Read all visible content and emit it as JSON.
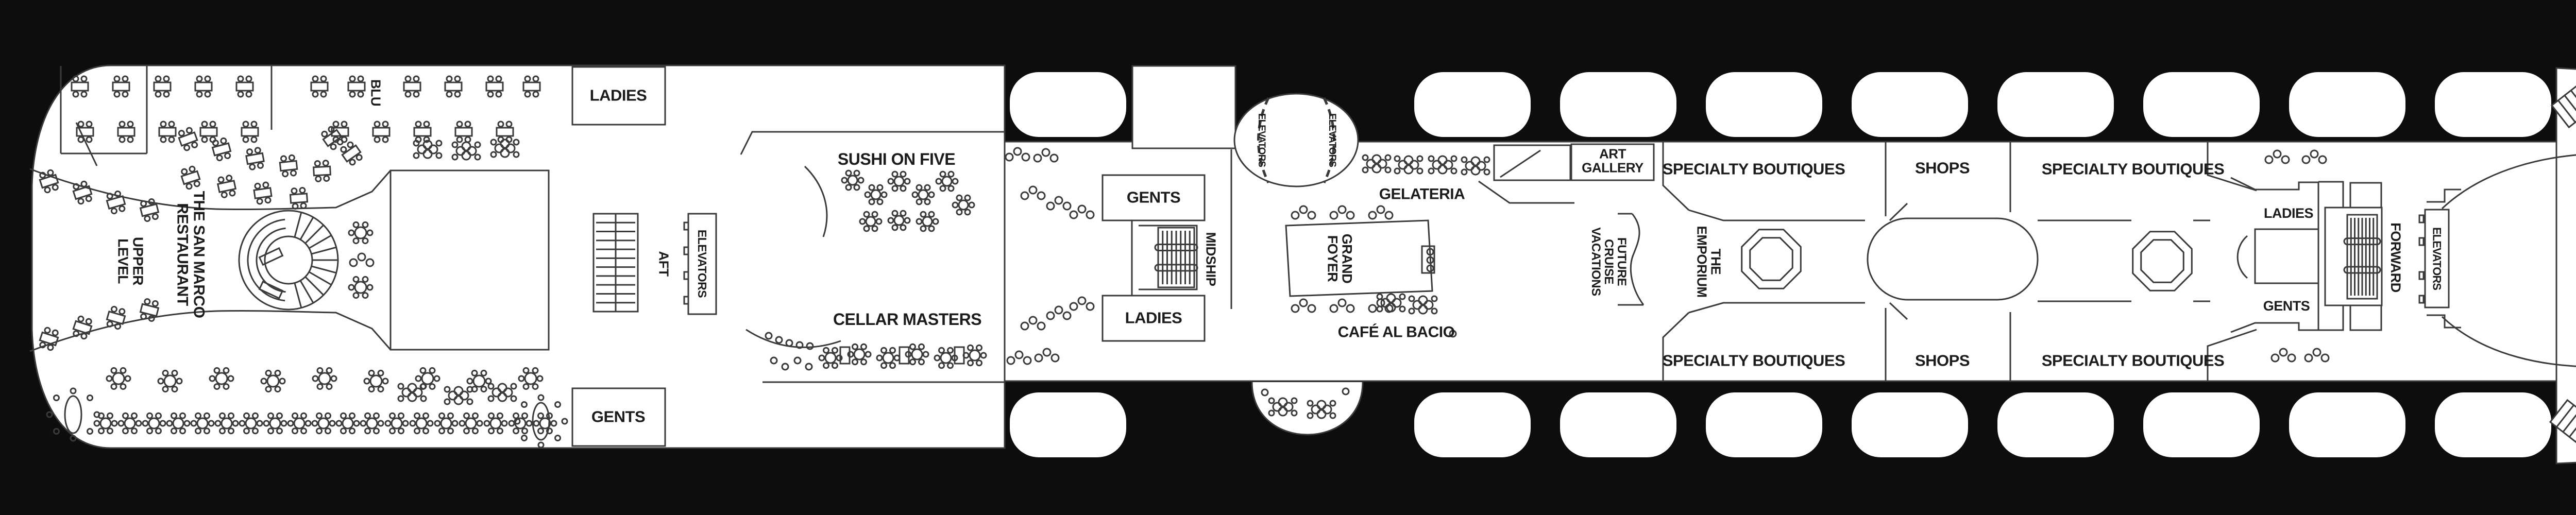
{
  "title": "Ship Deck Plan",
  "colors": {
    "background": "#0d0d0d",
    "deck_fill": "#ffffff",
    "outline": "#3a3a3a",
    "label_text": "#1c1c1c"
  },
  "stern": {
    "restaurant": {
      "line1": "THE SAN MARCO",
      "line2": "RESTAURANT"
    },
    "level": {
      "line1": "UPPER",
      "line2": "LEVEL"
    },
    "blu": "BLU",
    "ladies": "LADIES",
    "gents": "GENTS",
    "aft": "AFT",
    "elevators": "ELEVATORS",
    "sushi": "SUSHI ON FIVE",
    "cellar": "CELLAR MASTERS"
  },
  "midship": {
    "gents": "GENTS",
    "ladies": "LADIES",
    "midship": "MIDSHIP",
    "elevators_left": "ELEVATORS",
    "elevators_right": "ELEVATORS",
    "foyer": {
      "line1": "GRAND",
      "line2": "FOYER"
    },
    "gelateria": "GELATERIA",
    "cafe": "CAFÉ AL BACIO",
    "art": {
      "line1": "ART",
      "line2": "GALLERY"
    },
    "future_cruise": {
      "line1": "FUTURE",
      "line2": "CRUISE",
      "line3": "VACATIONS"
    },
    "emporium": {
      "line1": "THE",
      "line2": "EMPORIUM"
    },
    "boutiques_top_left": "SPECIALTY BOUTIQUES",
    "shops_top": "SHOPS",
    "boutiques_top_right": "SPECIALTY BOUTIQUES",
    "boutiques_bottom_left": "SPECIALTY BOUTIQUES",
    "shops_bottom": "SHOPS",
    "boutiques_bottom_right": "SPECIALTY BOUTIQUES"
  },
  "forward_section": {
    "ladies": "LADIES",
    "gents": "GENTS",
    "forward": "FORWARD",
    "elevators": "ELEVATORS",
    "theatre": "THE THEATRE"
  }
}
